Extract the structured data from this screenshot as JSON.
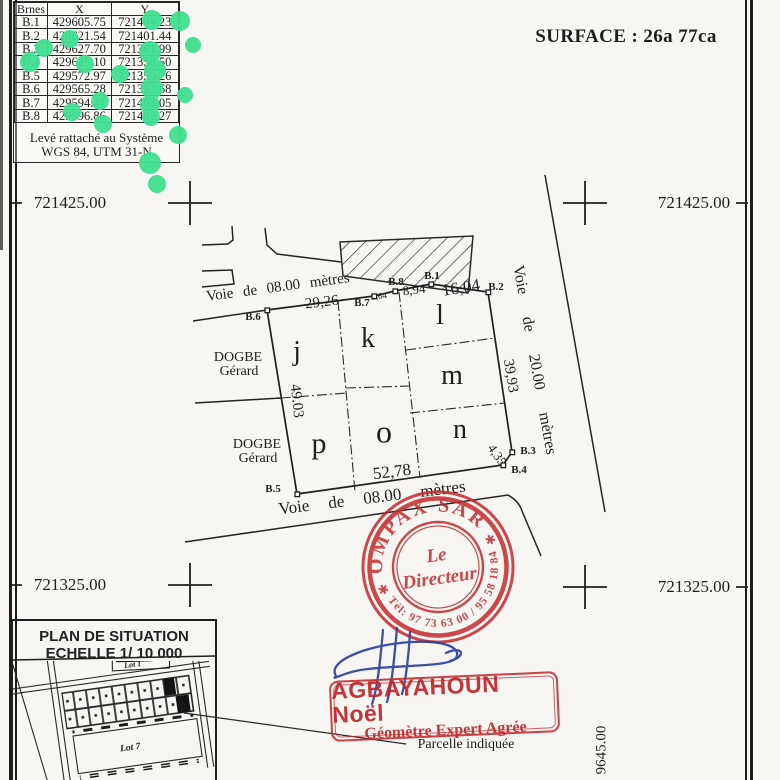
{
  "surface_label": "SURFACE : 26a 77ca",
  "colors": {
    "stamp_red": "#c5292c",
    "signature_blue": "#2b3f9e",
    "dot_green": "#3fe090",
    "ink": "#1d1d1d"
  },
  "coords_table": {
    "headers": {
      "bornes": "Brnes",
      "x": "X",
      "y": "Y"
    },
    "rows": [
      {
        "id": "B.1",
        "x": "429605.75",
        "y": "721404.23"
      },
      {
        "id": "B.2",
        "x": "429621.54",
        "y": "721401.44"
      },
      {
        "id": "B.3",
        "x": "429627.70",
        "y": "721361.99"
      },
      {
        "id": "B.4",
        "x": "429625.10",
        "y": "721358.50"
      },
      {
        "id": "B.5",
        "x": "429572.97",
        "y": "721350.26"
      },
      {
        "id": "B.6",
        "x": "429565.28",
        "y": "721393.68"
      },
      {
        "id": "B.7",
        "x": "429594.41",
        "y": "721403.05"
      },
      {
        "id": "B.8",
        "x": "429596.86",
        "y": "721402.27"
      }
    ],
    "datum_note_line1": "Levé rattaché au Système",
    "datum_note_line2": "WGS 84, UTM 31-N"
  },
  "grid": {
    "top_left": "721425.00",
    "top_right": "721425.00",
    "bottom_left": "721325.00",
    "bottom_right": "721325.00",
    "right_edge_vertical": "9645.00"
  },
  "plan": {
    "roads": {
      "top": "Voie de 08.00 mètres",
      "bottom": "Voie de 08.00 mètres",
      "right": "Voie de 20.00 mètres"
    },
    "measurements": {
      "b6_b7": "29,26",
      "b7_b8": "2,64",
      "b8_b1": "8,94",
      "b1_b2": "16,04",
      "b2_b3": "39,93",
      "b3_b4": "4,35",
      "b4_b5": "52,78",
      "b5_b6": "49.03"
    },
    "lots": [
      "j",
      "k",
      "l",
      "m",
      "n",
      "o",
      "p"
    ],
    "neighbor1": {
      "line1": "DOGBE",
      "line2": "Gérard"
    },
    "neighbor2": {
      "line1": "DOGBE",
      "line2": "Gérard"
    }
  },
  "stamp_round": {
    "org": "COMPAX SARL",
    "phone": "Tél: 97 73 63 00 / 95 58 18 84",
    "title_line1": "Le",
    "title_line2": "Directeur",
    "star_left": "✱",
    "star_right": "✱"
  },
  "stamp_rect": {
    "name": "AGBAYAHOUN Noël",
    "title": "Géomètre Expert Agrée"
  },
  "situation": {
    "title_line1": "PLAN DE SITUATION",
    "title_line2": "ECHELLE 1/ 10 000",
    "lot1": "Lot 1",
    "lot7": "Lot 7"
  },
  "callout": {
    "parcel_note": "Parcelle indiquée"
  }
}
